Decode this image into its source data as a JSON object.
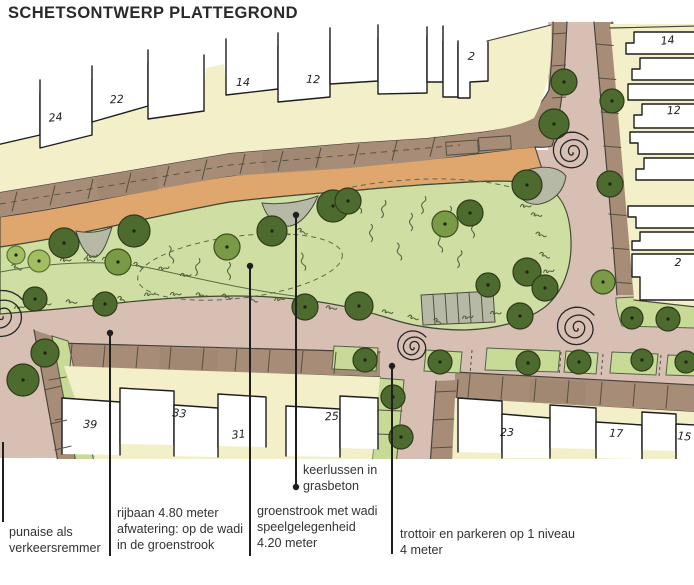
{
  "title": "SCHETSONTWERP PLATTEGROND",
  "plan": {
    "colors": {
      "yellow": "#f3f0c9",
      "pink": "#d8bfb4",
      "orange": "#dfa76e",
      "brown": "#a78d77",
      "green": "#cfdfa3",
      "verge": "#c7db97",
      "gray": "#b6b9a6",
      "outline": "#45413a",
      "tree_dark": "#4e6b2f",
      "tree_mid": "#7b9a45",
      "tree_light": "#a3bd62"
    },
    "house_numbers": [
      {
        "label": "24",
        "x": 56,
        "y": 121
      },
      {
        "label": "22",
        "x": 117,
        "y": 103
      },
      {
        "label": "14",
        "x": 243,
        "y": 86
      },
      {
        "label": "12",
        "x": 313,
        "y": 83
      },
      {
        "label": "2",
        "x": 471,
        "y": 60
      },
      {
        "label": "14",
        "x": 668,
        "y": 44
      },
      {
        "label": "12",
        "x": 674,
        "y": 114
      },
      {
        "label": "2",
        "x": 678,
        "y": 266
      },
      {
        "label": "39",
        "x": 90,
        "y": 428
      },
      {
        "label": "33",
        "x": 179,
        "y": 417
      },
      {
        "label": "31",
        "x": 239,
        "y": 438
      },
      {
        "label": "25",
        "x": 332,
        "y": 420
      },
      {
        "label": "23",
        "x": 507,
        "y": 436
      },
      {
        "label": "17",
        "x": 616,
        "y": 437
      },
      {
        "label": "15",
        "x": 684,
        "y": 440
      }
    ],
    "trees": [
      [
        16,
        255,
        9,
        "l"
      ],
      [
        39,
        261,
        11,
        "l"
      ],
      [
        64,
        243,
        15,
        "d"
      ],
      [
        118,
        262,
        13,
        "m"
      ],
      [
        134,
        231,
        16,
        "d"
      ],
      [
        227,
        247,
        13,
        "m"
      ],
      [
        272,
        231,
        15,
        "d"
      ],
      [
        333,
        206,
        16,
        "d"
      ],
      [
        348,
        201,
        13,
        "d"
      ],
      [
        445,
        224,
        13,
        "m"
      ],
      [
        470,
        213,
        13,
        "d"
      ],
      [
        527,
        185,
        15,
        "d"
      ],
      [
        488,
        285,
        12,
        "d"
      ],
      [
        527,
        272,
        14,
        "d"
      ],
      [
        545,
        288,
        13,
        "d"
      ],
      [
        305,
        307,
        13,
        "d"
      ],
      [
        359,
        306,
        14,
        "d"
      ],
      [
        520,
        316,
        13,
        "d"
      ],
      [
        35,
        299,
        12,
        "d"
      ],
      [
        105,
        304,
        12,
        "d"
      ],
      [
        45,
        353,
        14,
        "d"
      ],
      [
        23,
        380,
        16,
        "d"
      ],
      [
        365,
        360,
        12,
        "d"
      ],
      [
        440,
        362,
        12,
        "d"
      ],
      [
        528,
        363,
        12,
        "d"
      ],
      [
        579,
        362,
        12,
        "d"
      ],
      [
        642,
        360,
        11,
        "d"
      ],
      [
        686,
        362,
        11,
        "d"
      ],
      [
        393,
        397,
        12,
        "d"
      ],
      [
        401,
        437,
        12,
        "d"
      ],
      [
        564,
        82,
        13,
        "d"
      ],
      [
        554,
        124,
        15,
        "d"
      ],
      [
        612,
        101,
        12,
        "d"
      ],
      [
        610,
        184,
        13,
        "d"
      ],
      [
        603,
        282,
        12,
        "m"
      ],
      [
        632,
        318,
        11,
        "d"
      ],
      [
        668,
        319,
        12,
        "d"
      ]
    ],
    "spirals": [
      [
        2,
        316,
        27
      ],
      [
        572,
        152,
        21
      ],
      [
        577,
        328,
        22
      ],
      [
        413,
        347,
        17
      ]
    ]
  },
  "annotations": [
    {
      "id": "punaise",
      "text": "punaise als\nverkeersremmer",
      "line": {
        "x": 3,
        "y1": 442,
        "y2": 522
      },
      "dots": [],
      "label": {
        "x": 9,
        "y": 524
      }
    },
    {
      "id": "rijbaan",
      "text": "rijbaan 4.80 meter\nafwatering: op de wadi\nin de groenstrook",
      "line": {
        "x": 110,
        "y1": 333,
        "y2": 556
      },
      "dots": [
        [
          110,
          333
        ]
      ],
      "label": {
        "x": 117,
        "y": 505
      }
    },
    {
      "id": "groenstrook",
      "text": "groenstrook met wadi\nspeelgelegenheid\n4.20 meter",
      "line": {
        "x": 250,
        "y1": 266,
        "y2": 556
      },
      "dots": [
        [
          250,
          266
        ]
      ],
      "label": {
        "x": 257,
        "y": 503
      }
    },
    {
      "id": "keerlussen",
      "text": "keerlussen in\ngrasbeton",
      "line": {
        "x": 296,
        "y1": 215,
        "y2": 487
      },
      "dots": [
        [
          296,
          215
        ],
        [
          296,
          487
        ]
      ],
      "label": {
        "x": 303,
        "y": 462
      }
    },
    {
      "id": "trottoir",
      "text": "trottoir en parkeren op 1 niveau\n4 meter",
      "line": {
        "x": 392,
        "y1": 366,
        "y2": 554
      },
      "dots": [
        [
          392,
          366
        ]
      ],
      "label": {
        "x": 400,
        "y": 526
      }
    }
  ]
}
